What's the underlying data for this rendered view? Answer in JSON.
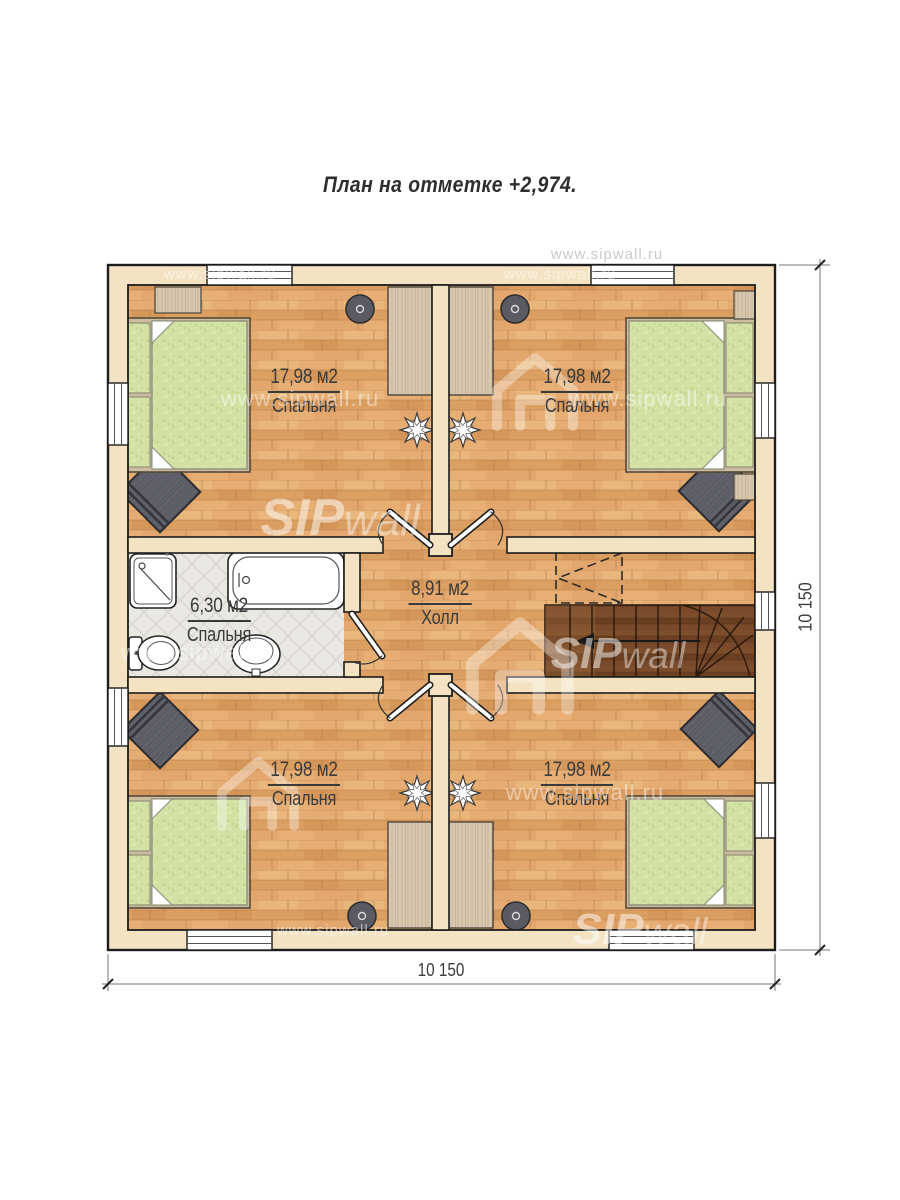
{
  "title": {
    "text": "План на отметке +2,974."
  },
  "rooms": [
    {
      "id": "bedroom-top-left",
      "area": "17,98 м2",
      "name": "Спальня"
    },
    {
      "id": "bedroom-top-right",
      "area": "17,98 м2",
      "name": "Спальня"
    },
    {
      "id": "bathroom",
      "area": "6,30 м2",
      "name": "Спальня"
    },
    {
      "id": "hall",
      "area": "8,91 м2",
      "name": "Холл"
    },
    {
      "id": "bedroom-bottom-left",
      "area": "17,98 м2",
      "name": "Спальня"
    },
    {
      "id": "bedroom-bottom-right",
      "area": "17,98 м2",
      "name": "Спальня"
    }
  ],
  "dimensions": {
    "bottom": "10 150",
    "right": "10 150"
  },
  "watermark": {
    "url": "www.sipwall.ru",
    "brand_bold": "SIP",
    "brand_light": "wall"
  },
  "colors": {
    "wall_fill": "#f3e3c3",
    "outline": "#1d1d1d",
    "floor_wood": "#e1a469",
    "stairs_wood": "#744727",
    "tile": "#eae8e3",
    "bed_green": "#d2e2a4",
    "rug_gray": "#60616b",
    "furniture_tan": "#d9c9b2",
    "label_text": "#3b3b3b"
  }
}
